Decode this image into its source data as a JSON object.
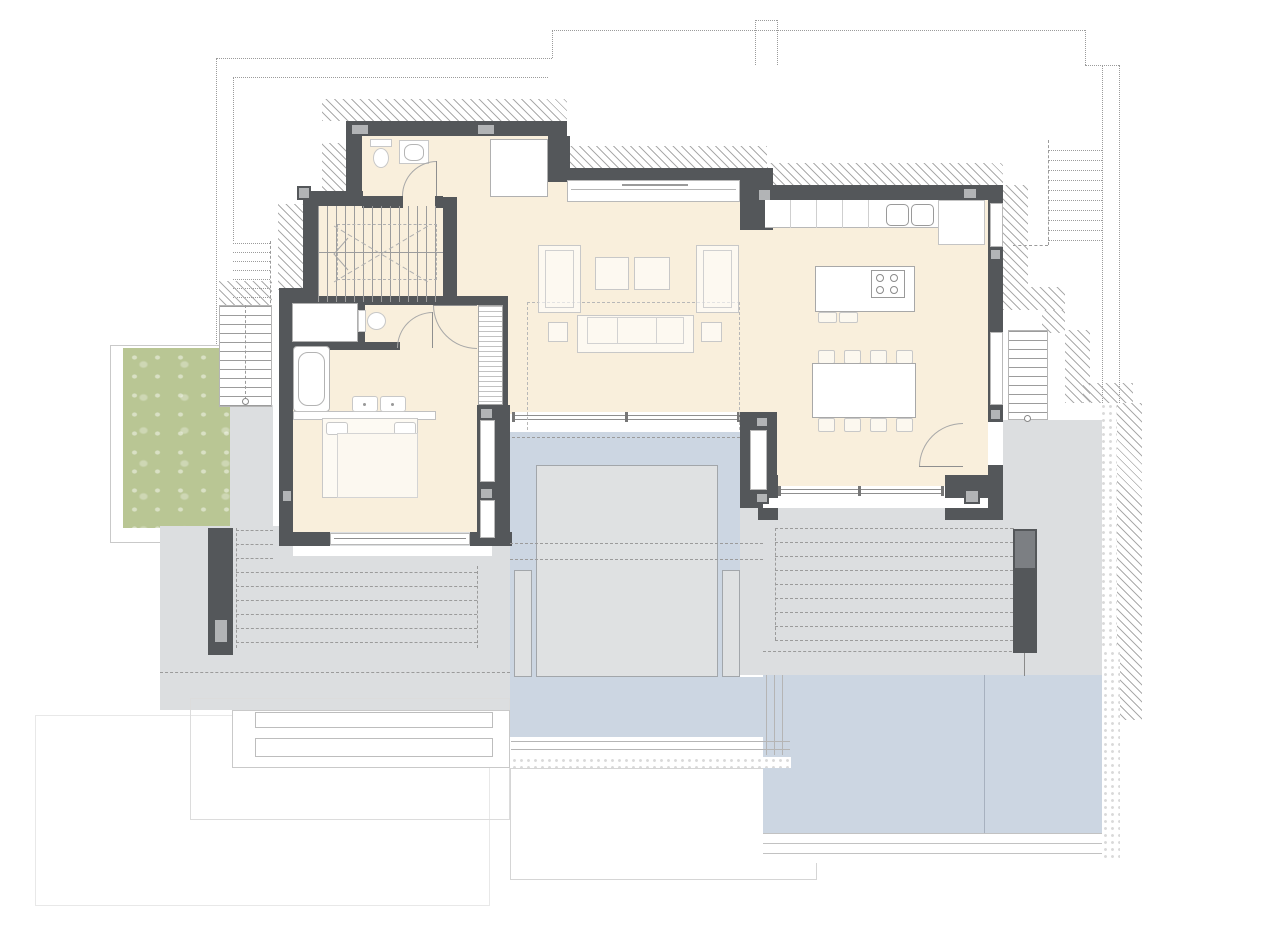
{
  "plan": {
    "type": "architectural floor plan, main living level with terraces and pool",
    "depicted_elements": {
      "dining_chairs": 8,
      "kitchen_island_stools": 2,
      "hob_burners": 4,
      "kitchen_sink_basins": 2,
      "armchairs": 2,
      "coffee_tables": 2,
      "side_tables": 2,
      "sofas": 1,
      "beds": 1,
      "bed_pillows": 2,
      "bathtubs": 1,
      "washbasins_double_vanity": 2,
      "toilets": 2,
      "wc_sinks": 1,
      "interior_staircases": 1,
      "exterior_staircases": 2,
      "dashed_upper_level_staircases": 2,
      "pergola_dash_rows_left": 9,
      "pergola_dash_rows_right": 9,
      "pool_platforms": 3,
      "terrace_pillars": 2
    }
  },
  "colors": {
    "wall": "#54575a",
    "column": "#b2b4b6",
    "floor": "#f9efdc",
    "terrace": "#dcdee0",
    "pool": "#ccd6e2",
    "platform": "#dfe1e2",
    "grass": "#b9c694",
    "furniture": "#c8c8c8",
    "line": "#9c9c9c",
    "hatch": "#ababab",
    "dash": "#9b9b9b",
    "pebble": "#d9d9d9",
    "glass": "#8f8f8f"
  }
}
